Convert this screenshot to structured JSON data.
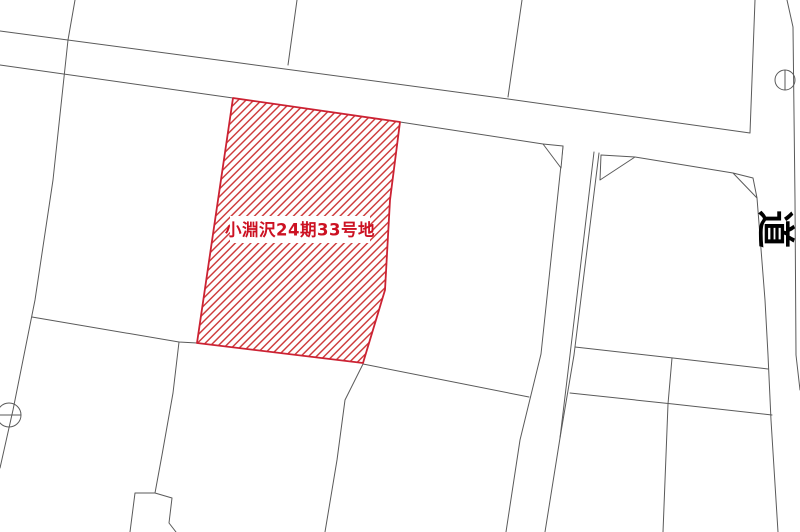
{
  "map": {
    "parcel": {
      "label": "小淵沢24期33号地"
    },
    "road": {
      "label": "道"
    },
    "colors": {
      "parcel_hatch": "#cc3333",
      "parcel_border": "#cc2233",
      "parcel_label_text": "#cc1122",
      "boundary_line": "#5a5a5a",
      "road_label_text": "#000000",
      "background": "#ffffff"
    }
  }
}
